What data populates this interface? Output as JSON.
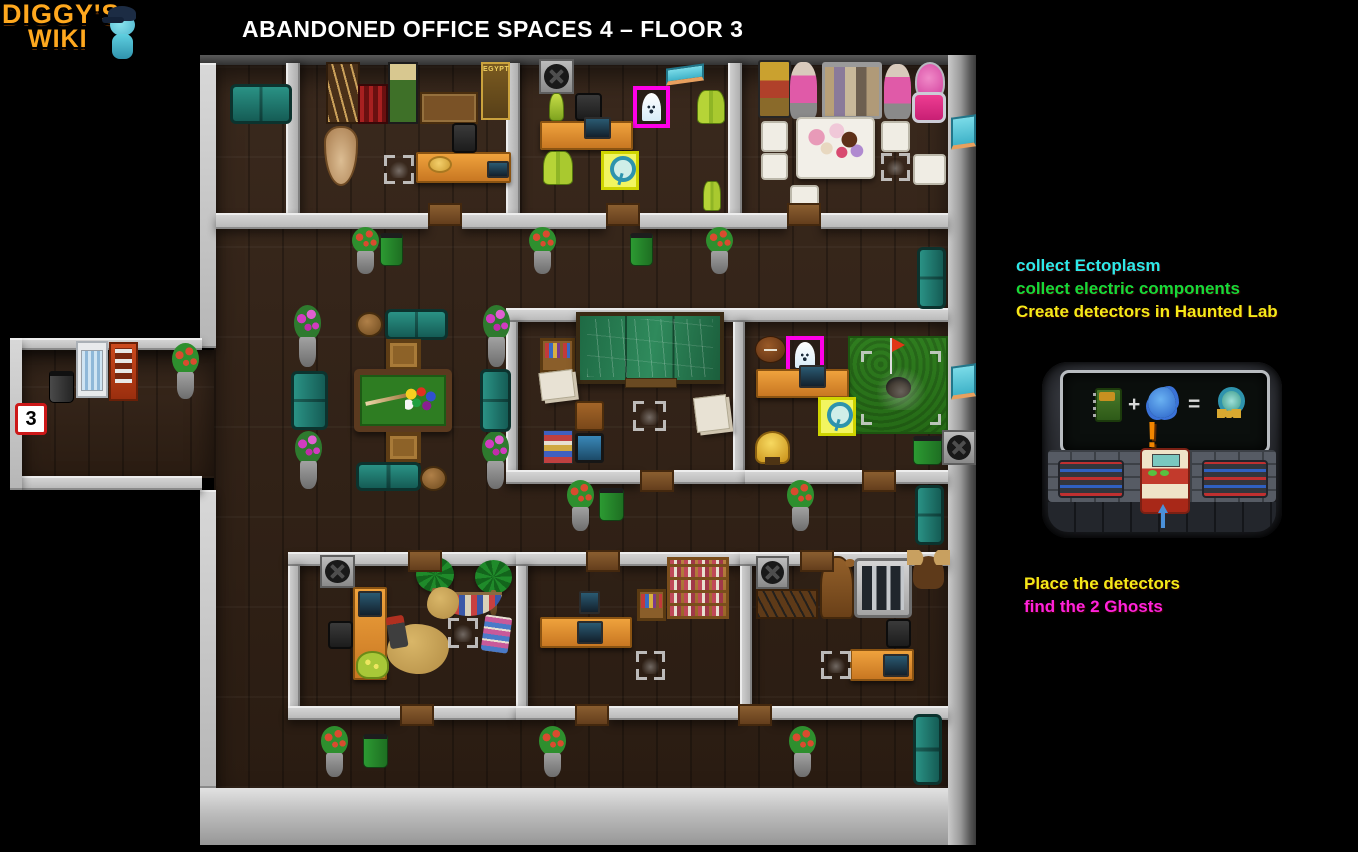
{
  "logo": {
    "line1": "DIGGY'S",
    "line2": "WIKI",
    "mascot": "diggy-mascot"
  },
  "header": {
    "title": "ABANDONED OFFICE SPACES 4 – FLOOR 3"
  },
  "instructions": {
    "top": [
      {
        "text": "collect Ectoplasm",
        "color": "#2ee8e8"
      },
      {
        "text": "collect electric components",
        "color": "#16d93a"
      },
      {
        "text": "Create detectors in Haunted Lab",
        "color": "#f5e818"
      }
    ],
    "bottom": [
      {
        "text": "Place the detectors",
        "color": "#f5e818"
      },
      {
        "text": "find the 2 Ghosts",
        "color": "#ff22dd"
      }
    ]
  },
  "recipe": {
    "ingredient_1": "electric-component",
    "plus": "+",
    "ingredient_2": "ectoplasm",
    "equals": "=",
    "result": "ghost-detector",
    "exclamation": "!"
  },
  "colors": {
    "ghost_highlight": "#ff00e8",
    "detector_highlight": "#f2f560",
    "wall": "#c8c8c8",
    "floor": "#32231a"
  },
  "map": {
    "entrance_label": "3",
    "ghost_count": 2,
    "items": [
      {
        "n": "teal-couch",
        "k": "couch-h",
        "x": 230,
        "y": 84,
        "w": 62,
        "h": 40
      },
      {
        "n": "spear-rack",
        "k": "spear-rack",
        "x": 326,
        "y": 62,
        "w": 34,
        "h": 62
      },
      {
        "n": "red-rack",
        "k": "red-rack",
        "x": 358,
        "y": 84,
        "w": 30,
        "h": 40
      },
      {
        "n": "diggy-poster",
        "k": "poster-green",
        "x": 388,
        "y": 62,
        "w": 30,
        "h": 62
      },
      {
        "n": "workbench",
        "k": "bench",
        "x": 420,
        "y": 92,
        "w": 58,
        "h": 32
      },
      {
        "n": "egypt-poster",
        "k": "poster-gold",
        "x": 481,
        "y": 62,
        "w": 29,
        "h": 58,
        "l": "EGYPT"
      },
      {
        "n": "vase",
        "k": "vase",
        "x": 324,
        "y": 126,
        "w": 34,
        "h": 60
      },
      {
        "n": "hand-search-marker",
        "k": "hand",
        "x": 384,
        "y": 155,
        "w": 30,
        "h": 29
      },
      {
        "n": "desk",
        "k": "desk-h",
        "x": 416,
        "y": 152,
        "w": 95,
        "h": 31
      },
      {
        "n": "straw-hat",
        "k": "hat",
        "x": 428,
        "y": 156,
        "w": 24,
        "h": 17
      },
      {
        "n": "laptop",
        "k": "screen",
        "x": 487,
        "y": 161,
        "w": 22,
        "h": 17
      },
      {
        "n": "office-chair",
        "k": "chair-office",
        "x": 452,
        "y": 123,
        "w": 25,
        "h": 30
      },
      {
        "n": "fan-vent",
        "k": "fan",
        "x": 539,
        "y": 59,
        "w": 35,
        "h": 35
      },
      {
        "n": "wall-sign",
        "k": "sign",
        "x": 666,
        "y": 66,
        "w": 38,
        "h": 17
      },
      {
        "n": "ghost-1",
        "k": "ghost",
        "x": 633,
        "y": 86,
        "w": 37,
        "h": 42
      },
      {
        "n": "ectoplasm-bottle",
        "k": "bottle",
        "x": 549,
        "y": 93,
        "w": 15,
        "h": 28
      },
      {
        "n": "office-chair",
        "k": "chair-office",
        "x": 575,
        "y": 93,
        "w": 27,
        "h": 28
      },
      {
        "n": "ectoplasm-bottles",
        "k": "bottles",
        "x": 697,
        "y": 90,
        "w": 28,
        "h": 34
      },
      {
        "n": "desk",
        "k": "desk-h",
        "x": 540,
        "y": 121,
        "w": 93,
        "h": 29
      },
      {
        "n": "computer",
        "k": "screen",
        "x": 584,
        "y": 117,
        "w": 27,
        "h": 22
      },
      {
        "n": "ectoplasm-bottles",
        "k": "bottles",
        "x": 543,
        "y": 151,
        "w": 30,
        "h": 34
      },
      {
        "n": "detector-1",
        "k": "detector",
        "x": 601,
        "y": 151,
        "w": 38,
        "h": 39
      },
      {
        "n": "ectoplasm-bottles",
        "k": "bottles",
        "x": 703,
        "y": 181,
        "w": 18,
        "h": 30
      },
      {
        "n": "luggage-stack",
        "k": "luggage",
        "x": 758,
        "y": 60,
        "w": 33,
        "h": 58
      },
      {
        "n": "mannequin",
        "k": "mannequin",
        "x": 790,
        "y": 62,
        "w": 27,
        "h": 57
      },
      {
        "n": "clothes-rack",
        "k": "clothes-rack",
        "x": 822,
        "y": 62,
        "w": 60,
        "h": 57
      },
      {
        "n": "mannequin",
        "k": "mannequin",
        "x": 884,
        "y": 64,
        "w": 27,
        "h": 55
      },
      {
        "n": "pink-lamp",
        "k": "pink-lamp",
        "x": 915,
        "y": 62,
        "w": 30,
        "h": 39
      },
      {
        "n": "pink-armchair",
        "k": "pink-armchair",
        "x": 912,
        "y": 92,
        "w": 34,
        "h": 31
      },
      {
        "n": "tea-table",
        "k": "tea-table",
        "x": 796,
        "y": 117,
        "w": 79,
        "h": 62
      },
      {
        "n": "white-chair",
        "k": "chair-white",
        "x": 761,
        "y": 121,
        "w": 27,
        "h": 31
      },
      {
        "n": "white-chair",
        "k": "chair-white",
        "x": 761,
        "y": 153,
        "w": 27,
        "h": 27
      },
      {
        "n": "white-chair",
        "k": "chair-white",
        "x": 881,
        "y": 121,
        "w": 29,
        "h": 31
      },
      {
        "n": "white-chair",
        "k": "chair-white",
        "x": 913,
        "y": 154,
        "w": 33,
        "h": 31
      },
      {
        "n": "white-stool",
        "k": "chair-white",
        "x": 790,
        "y": 185,
        "w": 29,
        "h": 29
      },
      {
        "n": "hand-search-marker",
        "k": "hand",
        "x": 881,
        "y": 153,
        "w": 29,
        "h": 28
      },
      {
        "n": "flower-planter",
        "k": "planter",
        "x": 350,
        "y": 227,
        "w": 31,
        "h": 47
      },
      {
        "n": "trash-can",
        "k": "trash",
        "x": 380,
        "y": 233,
        "w": 23,
        "h": 33
      },
      {
        "n": "flower-planter",
        "k": "planter",
        "x": 527,
        "y": 227,
        "w": 31,
        "h": 47
      },
      {
        "n": "trash-can",
        "k": "trash",
        "x": 630,
        "y": 233,
        "w": 23,
        "h": 33
      },
      {
        "n": "flower-planter",
        "k": "planter",
        "x": 704,
        "y": 227,
        "w": 31,
        "h": 47
      },
      {
        "n": "teal-couch",
        "k": "couch-v",
        "x": 917,
        "y": 247,
        "w": 29,
        "h": 62
      },
      {
        "n": "door",
        "k": "door",
        "x": 428,
        "y": 203,
        "w": 34,
        "h": 23
      },
      {
        "n": "door",
        "k": "door",
        "x": 606,
        "y": 203,
        "w": 34,
        "h": 23
      },
      {
        "n": "door",
        "k": "door",
        "x": 787,
        "y": 203,
        "w": 34,
        "h": 23
      },
      {
        "n": "pink-flower-planter",
        "k": "planter-pink",
        "x": 292,
        "y": 305,
        "w": 31,
        "h": 62
      },
      {
        "n": "pink-flower-planter",
        "k": "planter-pink",
        "x": 481,
        "y": 305,
        "w": 31,
        "h": 62
      },
      {
        "n": "pink-flower-planter",
        "k": "planter-pink",
        "x": 293,
        "y": 431,
        "w": 31,
        "h": 58
      },
      {
        "n": "pink-flower-planter",
        "k": "planter-pink",
        "x": 480,
        "y": 431,
        "w": 31,
        "h": 58
      },
      {
        "n": "teal-couch",
        "k": "couch-h",
        "x": 385,
        "y": 309,
        "w": 63,
        "h": 31
      },
      {
        "n": "stool",
        "k": "stool",
        "x": 356,
        "y": 312,
        "w": 27,
        "h": 25
      },
      {
        "n": "crate",
        "k": "crate",
        "x": 386,
        "y": 339,
        "w": 35,
        "h": 32
      },
      {
        "n": "pool-table",
        "k": "pool-table",
        "x": 354,
        "y": 369,
        "w": 98,
        "h": 63
      },
      {
        "n": "teal-couch",
        "k": "couch-v",
        "x": 291,
        "y": 371,
        "w": 37,
        "h": 59
      },
      {
        "n": "teal-couch",
        "k": "couch-v",
        "x": 480,
        "y": 369,
        "w": 31,
        "h": 63
      },
      {
        "n": "crate",
        "k": "crate",
        "x": 386,
        "y": 432,
        "w": 35,
        "h": 31
      },
      {
        "n": "teal-couch",
        "k": "couch-h",
        "x": 356,
        "y": 462,
        "w": 65,
        "h": 29
      },
      {
        "n": "stool",
        "k": "stool",
        "x": 420,
        "y": 466,
        "w": 27,
        "h": 25
      },
      {
        "n": "trash-can",
        "k": "trash-dark",
        "x": 49,
        "y": 371,
        "w": 25,
        "h": 32
      },
      {
        "n": "fridge",
        "k": "fridge",
        "x": 76,
        "y": 341,
        "w": 32,
        "h": 57
      },
      {
        "n": "vending-machine",
        "k": "vending",
        "x": 109,
        "y": 342,
        "w": 29,
        "h": 59
      },
      {
        "n": "flower-planter",
        "k": "planter",
        "x": 170,
        "y": 343,
        "w": 31,
        "h": 56
      },
      {
        "n": "entrance-badge",
        "k": "badge",
        "x": 15,
        "y": 403,
        "w": 32,
        "h": 32,
        "l": "3"
      },
      {
        "n": "bookshelf",
        "k": "shelf",
        "x": 540,
        "y": 338,
        "w": 35,
        "h": 35
      },
      {
        "n": "chalkboard",
        "k": "board",
        "x": 576,
        "y": 312,
        "w": 148,
        "h": 72
      },
      {
        "n": "paper-pile",
        "k": "papers",
        "x": 540,
        "y": 371,
        "w": 34,
        "h": 28
      },
      {
        "n": "wooden-chair",
        "k": "chair-wood",
        "x": 575,
        "y": 401,
        "w": 29,
        "h": 30
      },
      {
        "n": "book-stack",
        "k": "books",
        "x": 543,
        "y": 430,
        "w": 30,
        "h": 34
      },
      {
        "n": "tablet",
        "k": "tablet",
        "x": 575,
        "y": 433,
        "w": 29,
        "h": 30
      },
      {
        "n": "hand-search-marker",
        "k": "hand",
        "x": 633,
        "y": 401,
        "w": 33,
        "h": 30
      },
      {
        "n": "paper-pile",
        "k": "papers",
        "x": 695,
        "y": 396,
        "w": 33,
        "h": 35
      },
      {
        "n": "football",
        "k": "football",
        "x": 755,
        "y": 336,
        "w": 31,
        "h": 27
      },
      {
        "n": "ghost-2",
        "k": "ghost",
        "x": 786,
        "y": 336,
        "w": 38,
        "h": 39
      },
      {
        "n": "golf-green",
        "k": "golf",
        "x": 848,
        "y": 336,
        "w": 100,
        "h": 98
      },
      {
        "n": "golf-flag",
        "k": "flag",
        "x": 890,
        "y": 338,
        "w": 18,
        "h": 36
      },
      {
        "n": "hand-search-marker",
        "k": "hand",
        "x": 861,
        "y": 351,
        "w": 80,
        "h": 74
      },
      {
        "n": "desk",
        "k": "desk-h",
        "x": 756,
        "y": 369,
        "w": 93,
        "h": 29
      },
      {
        "n": "computer",
        "k": "screen",
        "x": 799,
        "y": 365,
        "w": 27,
        "h": 23
      },
      {
        "n": "detector-2",
        "k": "detector",
        "x": 818,
        "y": 397,
        "w": 38,
        "h": 39
      },
      {
        "n": "trophy",
        "k": "trophy",
        "x": 755,
        "y": 431,
        "w": 35,
        "h": 33
      },
      {
        "n": "trash-can",
        "k": "trash",
        "x": 913,
        "y": 436,
        "w": 29,
        "h": 29
      },
      {
        "n": "fan-vent",
        "k": "fan",
        "x": 942,
        "y": 430,
        "w": 34,
        "h": 35
      },
      {
        "n": "door",
        "k": "door",
        "x": 640,
        "y": 470,
        "w": 34,
        "h": 22
      },
      {
        "n": "door",
        "k": "door",
        "x": 862,
        "y": 470,
        "w": 34,
        "h": 22
      },
      {
        "n": "flower-planter",
        "k": "planter",
        "x": 565,
        "y": 480,
        "w": 31,
        "h": 51
      },
      {
        "n": "trash-can",
        "k": "trash",
        "x": 599,
        "y": 488,
        "w": 25,
        "h": 33
      },
      {
        "n": "flower-planter",
        "k": "planter",
        "x": 785,
        "y": 480,
        "w": 31,
        "h": 51
      },
      {
        "n": "teal-couch",
        "k": "couch-v",
        "x": 915,
        "y": 485,
        "w": 29,
        "h": 60
      },
      {
        "n": "fan-vent",
        "k": "fan",
        "x": 320,
        "y": 555,
        "w": 35,
        "h": 33
      },
      {
        "n": "desk",
        "k": "desk-v",
        "x": 353,
        "y": 587,
        "w": 34,
        "h": 93
      },
      {
        "n": "phone",
        "k": "screen",
        "x": 358,
        "y": 591,
        "w": 24,
        "h": 26
      },
      {
        "n": "office-chair",
        "k": "chair-office",
        "x": 328,
        "y": 621,
        "w": 25,
        "h": 28
      },
      {
        "n": "palm-tree",
        "k": "palm-tree",
        "x": 416,
        "y": 557,
        "w": 38,
        "h": 57
      },
      {
        "n": "palm-tree",
        "k": "palm-tree",
        "x": 475,
        "y": 560,
        "w": 37,
        "h": 55
      },
      {
        "n": "hammock",
        "k": "hammock",
        "x": 435,
        "y": 592,
        "w": 67,
        "h": 24
      },
      {
        "n": "sand-pile",
        "k": "sand",
        "x": 427,
        "y": 587,
        "w": 32,
        "h": 32
      },
      {
        "n": "sand-pile",
        "k": "sand",
        "x": 387,
        "y": 624,
        "w": 62,
        "h": 50
      },
      {
        "n": "shovel",
        "k": "shovel",
        "x": 388,
        "y": 616,
        "w": 18,
        "h": 32
      },
      {
        "n": "hand-search-marker",
        "k": "hand",
        "x": 448,
        "y": 618,
        "w": 30,
        "h": 30
      },
      {
        "n": "beach-towel",
        "k": "beach-towel",
        "x": 483,
        "y": 616,
        "w": 27,
        "h": 36
      },
      {
        "n": "bag",
        "k": "bag",
        "x": 356,
        "y": 651,
        "w": 33,
        "h": 28
      },
      {
        "n": "wall-screen",
        "k": "screen",
        "x": 579,
        "y": 591,
        "w": 21,
        "h": 23
      },
      {
        "n": "desk",
        "k": "desk-h",
        "x": 540,
        "y": 617,
        "w": 92,
        "h": 31
      },
      {
        "n": "computer",
        "k": "screen",
        "x": 577,
        "y": 621,
        "w": 26,
        "h": 23
      },
      {
        "n": "bookcase-small",
        "k": "shelf",
        "x": 637,
        "y": 589,
        "w": 29,
        "h": 32
      },
      {
        "n": "bookcase",
        "k": "bookcase",
        "x": 667,
        "y": 557,
        "w": 62,
        "h": 62
      },
      {
        "n": "hand-search-marker",
        "k": "hand",
        "x": 636,
        "y": 651,
        "w": 29,
        "h": 29
      },
      {
        "n": "fan-vent",
        "k": "fan",
        "x": 756,
        "y": 556,
        "w": 33,
        "h": 33
      },
      {
        "n": "rifle-rack",
        "k": "rifles",
        "x": 756,
        "y": 589,
        "w": 62,
        "h": 30
      },
      {
        "n": "bear-statue",
        "k": "bear",
        "x": 820,
        "y": 556,
        "w": 34,
        "h": 63
      },
      {
        "n": "gun-cabinet",
        "k": "cabinet",
        "x": 854,
        "y": 558,
        "w": 58,
        "h": 60
      },
      {
        "n": "moose-head",
        "k": "moose",
        "x": 913,
        "y": 556,
        "w": 31,
        "h": 33
      },
      {
        "n": "office-chair",
        "k": "chair-office",
        "x": 886,
        "y": 619,
        "w": 25,
        "h": 29
      },
      {
        "n": "desk",
        "k": "desk-h",
        "x": 850,
        "y": 649,
        "w": 64,
        "h": 32
      },
      {
        "n": "computer",
        "k": "screen",
        "x": 883,
        "y": 654,
        "w": 26,
        "h": 23
      },
      {
        "n": "hand-search-marker",
        "k": "hand",
        "x": 821,
        "y": 651,
        "w": 30,
        "h": 28
      },
      {
        "n": "door",
        "k": "door",
        "x": 408,
        "y": 550,
        "w": 34,
        "h": 22
      },
      {
        "n": "door",
        "k": "door",
        "x": 586,
        "y": 550,
        "w": 34,
        "h": 22
      },
      {
        "n": "door",
        "k": "door",
        "x": 800,
        "y": 550,
        "w": 34,
        "h": 22
      },
      {
        "n": "flower-planter",
        "k": "planter",
        "x": 319,
        "y": 726,
        "w": 31,
        "h": 51
      },
      {
        "n": "trash-can",
        "k": "trash",
        "x": 363,
        "y": 734,
        "w": 25,
        "h": 34
      },
      {
        "n": "flower-planter",
        "k": "planter",
        "x": 537,
        "y": 726,
        "w": 31,
        "h": 51
      },
      {
        "n": "flower-planter",
        "k": "planter",
        "x": 787,
        "y": 726,
        "w": 31,
        "h": 51
      },
      {
        "n": "teal-couch",
        "k": "couch-v",
        "x": 913,
        "y": 714,
        "w": 29,
        "h": 71
      },
      {
        "n": "door",
        "k": "door",
        "x": 400,
        "y": 704,
        "w": 34,
        "h": 22
      },
      {
        "n": "door",
        "k": "door",
        "x": 575,
        "y": 704,
        "w": 34,
        "h": 22
      },
      {
        "n": "door",
        "k": "door",
        "x": 738,
        "y": 704,
        "w": 34,
        "h": 22
      },
      {
        "n": "wall-sign",
        "k": "sign",
        "x": 951,
        "y": 116,
        "w": 25,
        "h": 32
      },
      {
        "n": "wall-sign",
        "k": "sign",
        "x": 951,
        "y": 365,
        "w": 25,
        "h": 33
      }
    ]
  }
}
